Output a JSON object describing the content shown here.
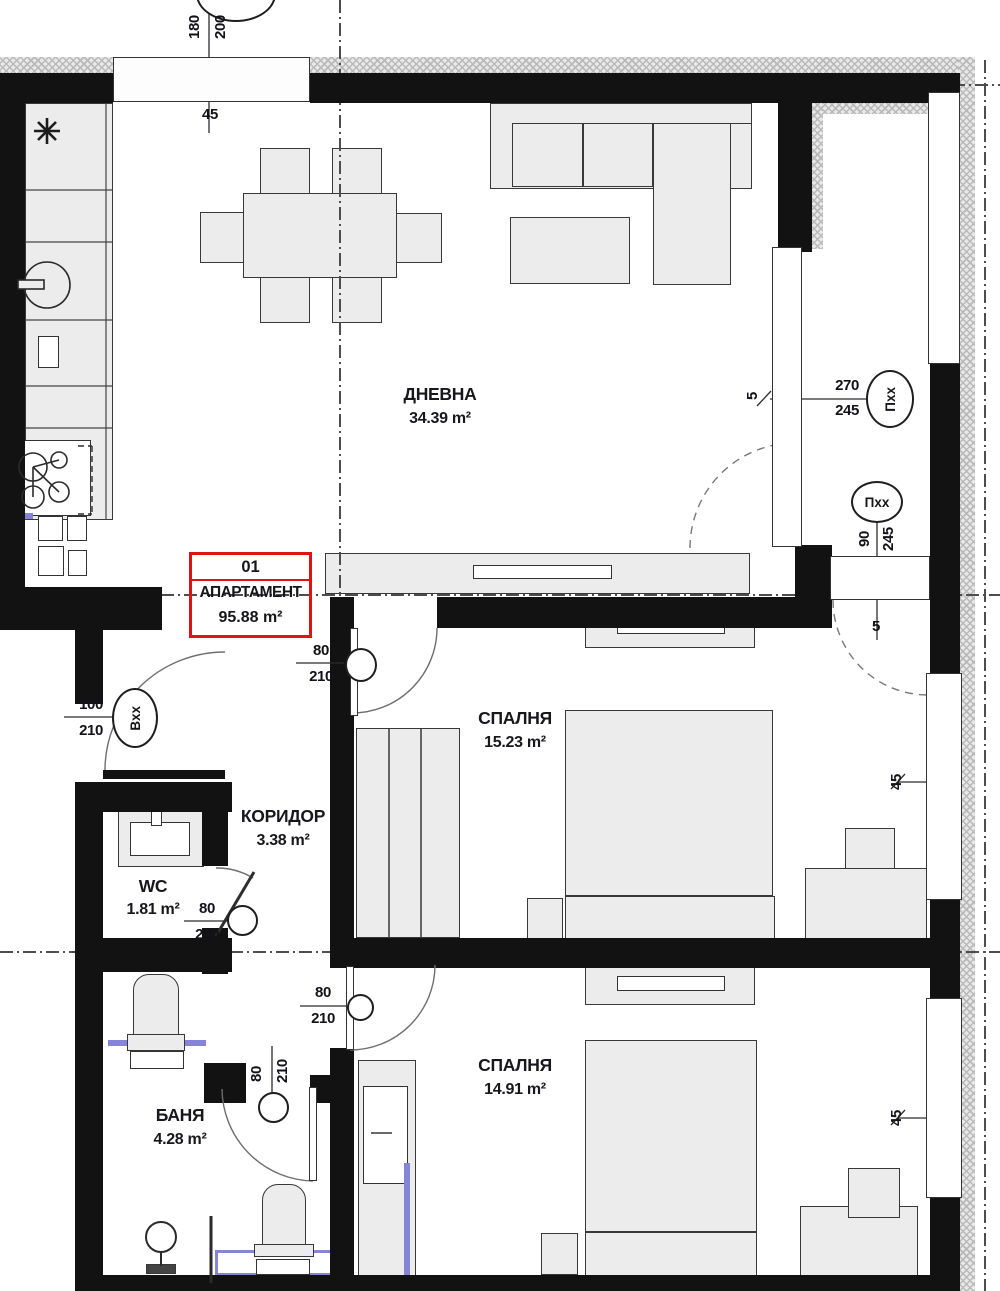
{
  "apartment": {
    "number": "01",
    "label": "АПАРТАМЕНТ",
    "area": "95.88 m²"
  },
  "rooms": {
    "living": {
      "name": "ДНЕВНА",
      "area": "34.39 m²"
    },
    "bedroom1": {
      "name": "СПАЛНЯ",
      "area": "15.23 m²"
    },
    "bedroom2": {
      "name": "СПАЛНЯ",
      "area": "14.91 m²"
    },
    "corridor": {
      "name": "КОРИДОР",
      "area": "3.38 m²"
    },
    "wc": {
      "name": "WC",
      "area": "1.81 m²"
    },
    "bath": {
      "name": "БАНЯ",
      "area": "4.28 m²"
    }
  },
  "openings": {
    "top_window": {
      "width": "180",
      "height": "200",
      "offset": "45"
    },
    "terrace_door": {
      "width": "270",
      "height": "245",
      "tag": "Пхх",
      "offset": "5"
    },
    "terrace_window": {
      "width": "90",
      "height": "245",
      "tag": "Пхх",
      "offset": "5"
    },
    "entrance_door": {
      "width": "100",
      "height": "210",
      "tag": "Вхх"
    },
    "bedroom1_door": {
      "width": "80",
      "height": "210"
    },
    "wc_door": {
      "width": "80",
      "height": "210"
    },
    "bath_door": {
      "width": "80",
      "height": "210"
    },
    "bedroom2_door": {
      "width": "80",
      "height": "210"
    },
    "right_window_1": {
      "offset": "45"
    },
    "right_window_2": {
      "offset": "45"
    }
  },
  "colors": {
    "wall": "#121212",
    "furniture_fill": "#ececec",
    "outline": "#383838",
    "apartment_box": "#e01313",
    "plumbing": "#8585d6",
    "axis": "#4d4d4d",
    "hatch": "#b9b9b9"
  }
}
